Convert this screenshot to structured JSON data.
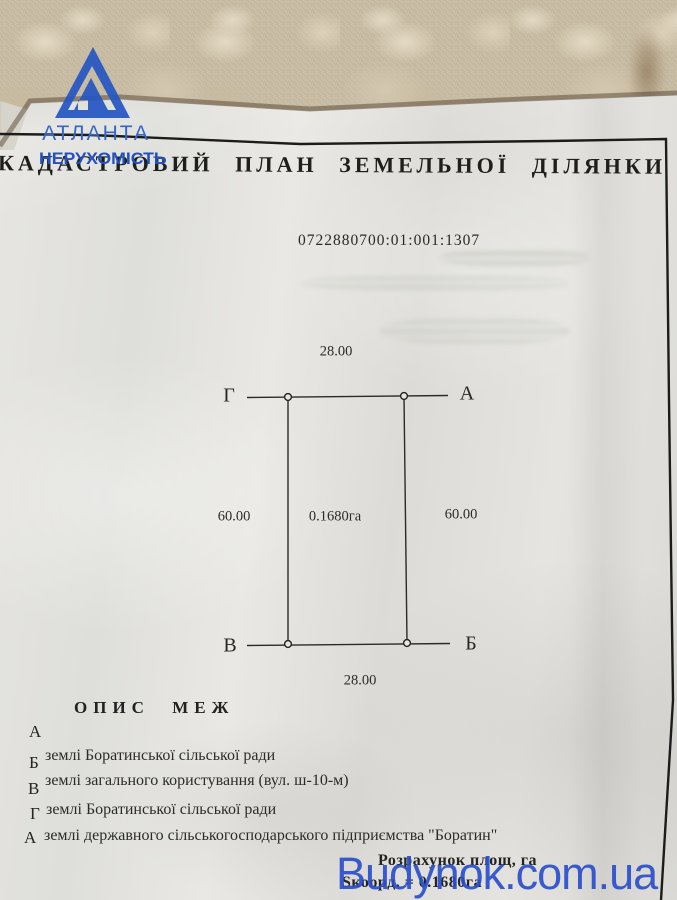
{
  "overlays": {
    "agency_logo": {
      "name": "АТЛАНТА",
      "subtitle": "НЕРУХОМІСТЬ",
      "color": "#2a5ac6"
    },
    "site_watermark": {
      "text": "Budynok.com.ua",
      "color": "#2b4fce"
    }
  },
  "document": {
    "title": "КАДАСТРОВИЙ ПЛАН ЗЕМЕЛЬНОЇ ДІЛЯНКИ",
    "cadastral_number": "0722880700:01:001:1307",
    "plot": {
      "corner_top_left": "Г",
      "corner_top_right": "А",
      "corner_bottom_left": "В",
      "corner_bottom_right": "Б",
      "side_top": "28.00",
      "side_bottom": "28.00",
      "side_left": "60.00",
      "side_right": "60.00",
      "area_label": "0.1680га"
    },
    "boundary_description": {
      "heading": "ОПИС МЕЖ",
      "rows": [
        {
          "letter": "А",
          "text": ""
        },
        {
          "letter": "Б",
          "text": "землі Боратинської сільської ради"
        },
        {
          "letter": "В",
          "text": "землі загального користування (вул. ш-10-м)"
        },
        {
          "letter": "Г",
          "text": "землі Боратинської сільської ради"
        },
        {
          "letter": "А",
          "text": "землі державного сільськогосподарського підприємства \"Боратин\""
        }
      ]
    },
    "area_calculation": {
      "line1": "Розрахунок площ, га",
      "line2": "Sкоорд. = 0.1680га"
    }
  }
}
